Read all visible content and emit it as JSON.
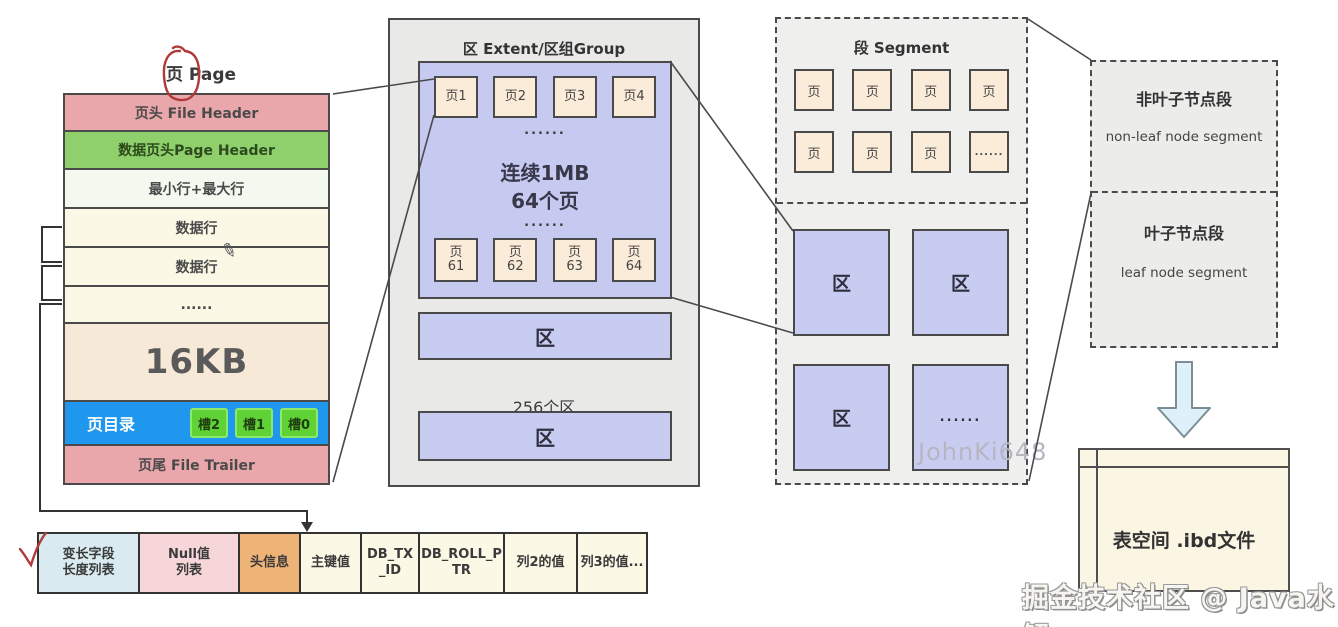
{
  "diagram": {
    "page": {
      "title": "页 Page",
      "rows": [
        {
          "label": "页头 File Header"
        },
        {
          "label": "数据页头Page Header"
        },
        {
          "label": "最小行+最大行"
        },
        {
          "label": "数据行"
        },
        {
          "label": "数据行"
        },
        {
          "label": "......"
        },
        {
          "label": "16KB"
        },
        {
          "label": "页目录",
          "slots": [
            "槽2",
            "槽1",
            "槽0"
          ]
        },
        {
          "label": "页尾 File Trailer"
        }
      ]
    },
    "extent": {
      "title": "区 Extent/区组Group",
      "top_pages": [
        "页1",
        "页2",
        "页3",
        "页4"
      ],
      "dots": "......",
      "size_label": "连续1MB",
      "pages_count_label": "64个页",
      "bottom_pages": [
        "页\n61",
        "页\n62",
        "页\n63",
        "页\n64"
      ],
      "extent_label": "区",
      "extents_count_label": "256个区"
    },
    "segment": {
      "title": "段 Segment",
      "page_label": "页",
      "dots": "......",
      "extent_label": "区"
    },
    "index_segments": {
      "non_leaf_title": "非叶子节点段",
      "non_leaf_subtitle": "non-leaf node segment",
      "leaf_title": "叶子节点段",
      "leaf_subtitle": "leaf node segment"
    },
    "tablespace": {
      "label": "表空间 .ibd文件"
    },
    "record": {
      "cells": [
        "变长字段\n长度列表",
        "Null值\n列表",
        "头信息",
        "主键值",
        "DB_TX\n_ID",
        "DB_ROLL_P\nTR",
        "列2的值",
        "列3的值..."
      ]
    }
  },
  "watermarks": {
    "segment_area": "JohnKi648",
    "bottom_right": "掘金技术社区 @ Java水解"
  },
  "colors": {
    "row_pink": "#e9a6ab",
    "row_green": "#8fd06c",
    "row_pale_green": "#f3f9ef",
    "row_cream": "#fbf8e6",
    "row_peach": "#f7e9d7",
    "row_blue": "#2097ee",
    "slot_green": "#5fd336",
    "extent_purple": "#c9ccf1",
    "page_box_peach": "#fbebd9",
    "panel_gray": "#e9e9e7",
    "tablespace_cream": "#fbf6e4",
    "record_blue": "#d9eaf0",
    "record_pink": "#f7d6da",
    "record_orange": "#eeb377",
    "annotation_red": "#b03a3a",
    "arrow_blue": "#def0f8"
  }
}
